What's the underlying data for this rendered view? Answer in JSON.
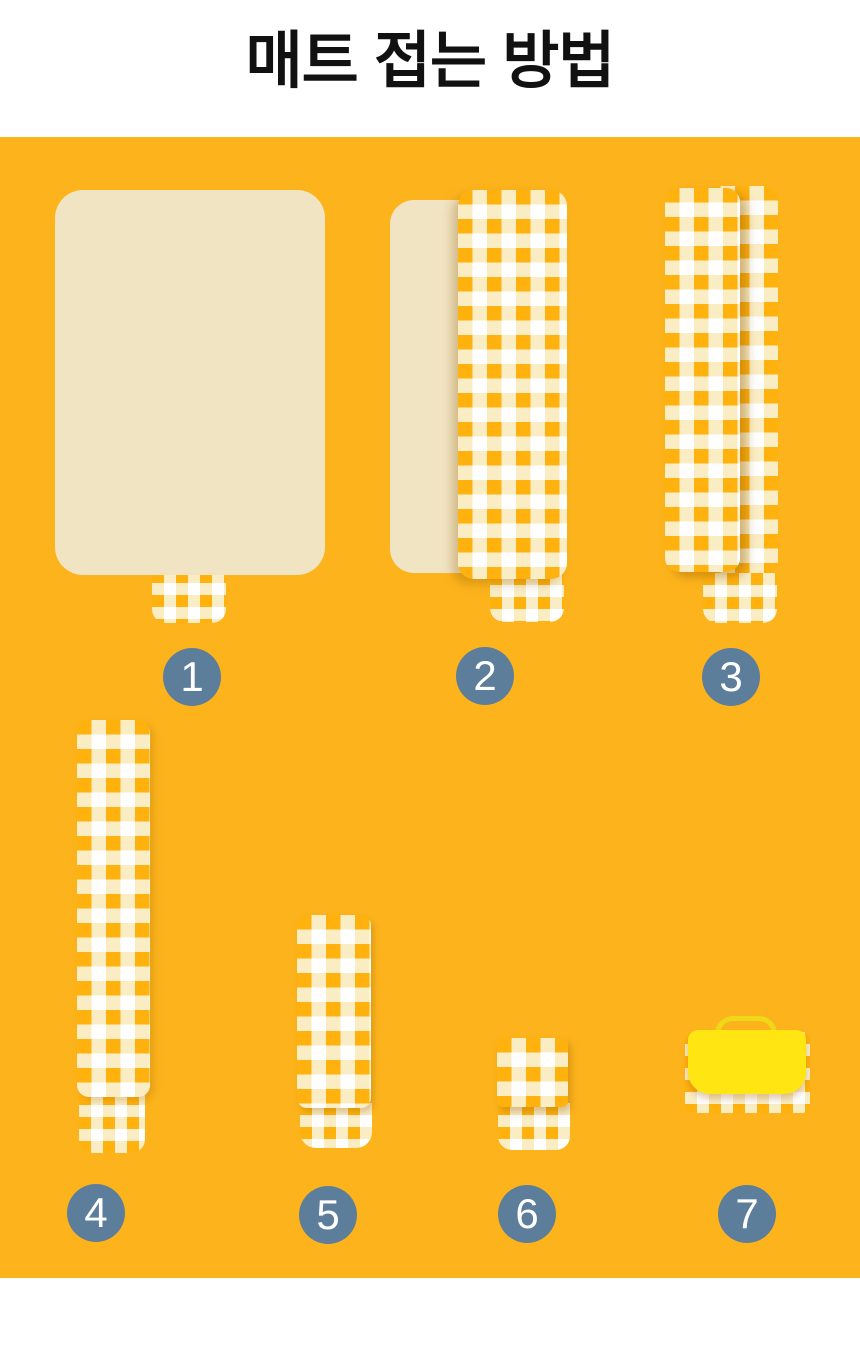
{
  "header": {
    "title": "매트 접는 방법"
  },
  "steps": [
    {
      "number": "1",
      "graphic": "mat-unfolded-back-icon"
    },
    {
      "number": "2",
      "graphic": "mat-half-folded-icon"
    },
    {
      "number": "3",
      "graphic": "mat-folded-strip-icon"
    },
    {
      "number": "4",
      "graphic": "strip-full-length-icon"
    },
    {
      "number": "5",
      "graphic": "strip-folded-half-icon"
    },
    {
      "number": "6",
      "graphic": "strip-folded-quarter-icon"
    },
    {
      "number": "7",
      "graphic": "mat-packed-with-handle-icon"
    }
  ],
  "colors": {
    "title_text": "#111111",
    "panel_background": "#FDB41C",
    "mat_back": "#F1E4C2",
    "gingham_orange": "#FFB10E",
    "gingham_cream": "#FAEDC4",
    "gingham_white": "#FFFFFF",
    "badge": "#5D7E9B",
    "badge_text": "#FFFFFF",
    "flap_yellow": "#FFE512",
    "handle_yellow": "#EFD818"
  }
}
